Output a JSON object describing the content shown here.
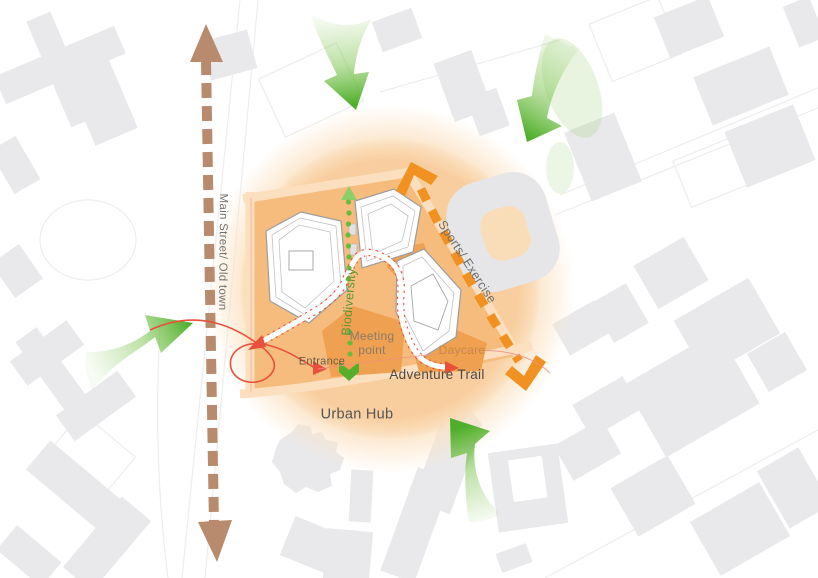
{
  "diagram": {
    "type": "urban-site-concept-plan",
    "labels": {
      "main_street": "Main Street/ Old town",
      "sports_exercise": "Sports/ Exercise",
      "biodiversity": "Biodiversity",
      "meeting_line1": "Meeting",
      "meeting_line2": "point",
      "daycare": "Daycare",
      "entrance": "Entrance",
      "adventure_trail": "Adventure Trail",
      "urban_hub": "Urban Hub"
    },
    "icons": [
      "main-street-double-arrow-icon",
      "pedestrian-flow-arrow-icon",
      "sports-exercise-dashed-arrow-icon",
      "biodiversity-dotted-arrow-icon",
      "adventure-trail-path-icon",
      "entrance-loop-arrow-icon"
    ],
    "colors": {
      "site_glow_outer": "#fbe2c3",
      "site_glow_inner": "#f8cc9b",
      "site_block": "#f5bc7d",
      "program_pentagon": "#efa050",
      "flow_green": "#4fae2b",
      "trail_orange": "#f19121",
      "street_brown": "#b98b6e",
      "route_red": "#e8503c",
      "building_gray": "#e9e9eb"
    }
  }
}
